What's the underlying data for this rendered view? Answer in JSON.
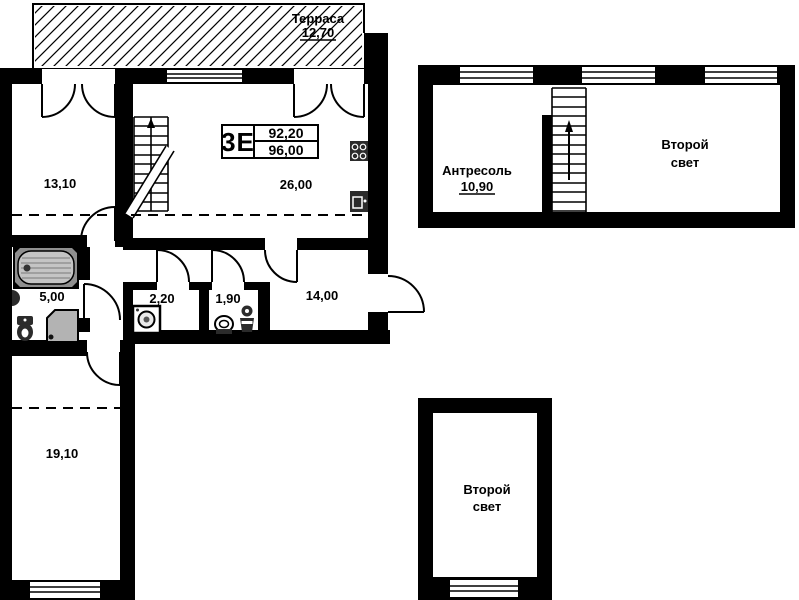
{
  "unit_stamp": {
    "type": "3Е",
    "area_upper": "92,20",
    "area_lower": "96,00"
  },
  "terrace": {
    "name": "Терраса",
    "area": "12,70"
  },
  "rooms": {
    "room_13_10": "13,10",
    "room_26_00": "26,00",
    "room_5_00": "5,00",
    "room_2_20": "2,20",
    "room_1_90": "1,90",
    "room_14_00": "14,00",
    "room_19_10": "19,10"
  },
  "mezzanine": {
    "name": "Антресоль",
    "area": "10,90",
    "second_light": {
      "line1": "Второй",
      "line2": "свет"
    }
  },
  "lower_void": {
    "second_light": {
      "line1": "Второй",
      "line2": "свет"
    }
  },
  "colors": {
    "wall": "#000000",
    "background": "#ffffff",
    "fixture_light": "#b3b3b3",
    "fixture_dark": "#2b2b2b"
  },
  "icons": [
    "bathtub-icon",
    "shower-icon",
    "toilet-icon",
    "wall-sink-icon",
    "washing-machine-icon",
    "stove-icon",
    "kitchen-sink-icon",
    "stairs-icon",
    "up-arrow-icon",
    "door-swing-arc",
    "window-glazing"
  ]
}
